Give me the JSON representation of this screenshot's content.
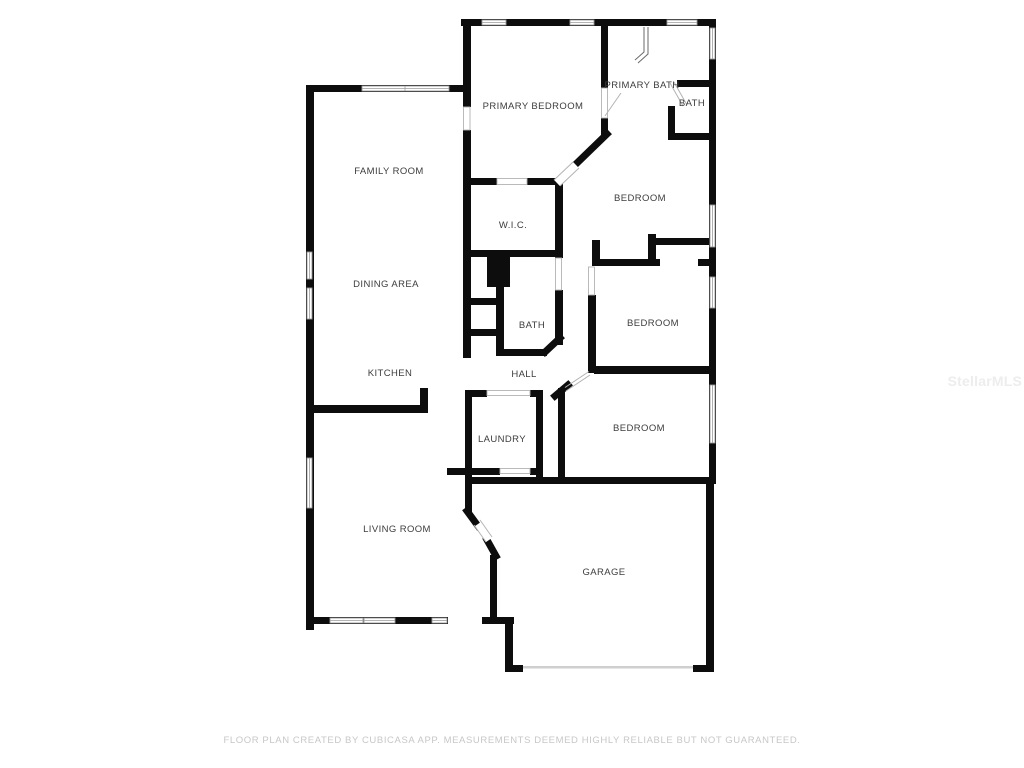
{
  "page": {
    "footer_text": "FLOOR PLAN CREATED BY CUBICASA APP. MEASUREMENTS DEEMED HIGHLY RELIABLE BUT NOT GUARANTEED.",
    "watermark": "StellarMLS"
  },
  "colors": {
    "background": "#ffffff",
    "wall": "#0d0d0d",
    "label": "#3d3d3d",
    "window_outline": "#9b9b9b",
    "footer": "#c7c7c7",
    "watermark": "#ededed"
  },
  "rooms": [
    {
      "id": "primary-bedroom",
      "label": "PRIMARY BEDROOM"
    },
    {
      "id": "primary-bath",
      "label": "PRIMARY BATH"
    },
    {
      "id": "bath-top",
      "label": "BATH"
    },
    {
      "id": "family-room",
      "label": "FAMILY ROOM"
    },
    {
      "id": "bedroom-1",
      "label": "BEDROOM"
    },
    {
      "id": "wic",
      "label": "W.I.C."
    },
    {
      "id": "dining-area",
      "label": "DINING AREA"
    },
    {
      "id": "bedroom-2",
      "label": "BEDROOM"
    },
    {
      "id": "bath-middle",
      "label": "BATH"
    },
    {
      "id": "kitchen",
      "label": "KITCHEN"
    },
    {
      "id": "hall",
      "label": "HALL"
    },
    {
      "id": "bedroom-3",
      "label": "BEDROOM"
    },
    {
      "id": "laundry",
      "label": "LAUNDRY"
    },
    {
      "id": "living-room",
      "label": "LIVING ROOM"
    },
    {
      "id": "garage",
      "label": "GARAGE"
    }
  ]
}
